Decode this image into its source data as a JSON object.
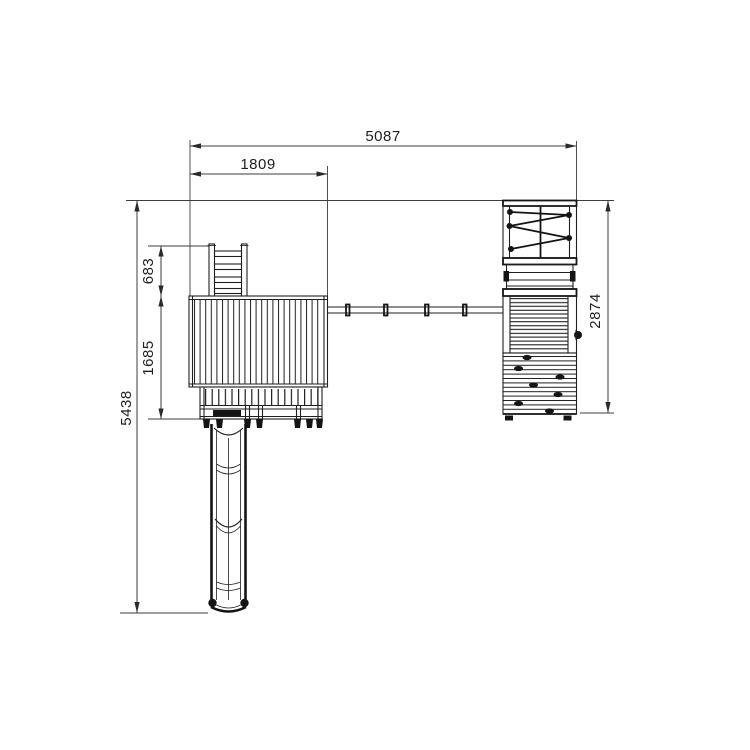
{
  "drawing": {
    "kind": "playground-set-top-view-technical-drawing",
    "background_color": "#ffffff",
    "structure_line_color": "#1f1f1f",
    "dimension_line_color": "#3d3d3d",
    "dimensions_mm": {
      "total_width": "5087",
      "tower_width": "1809",
      "ladder_depth": "683",
      "tower_depth": "1685",
      "total_depth": "5438",
      "right_module_depth": "2874"
    }
  }
}
